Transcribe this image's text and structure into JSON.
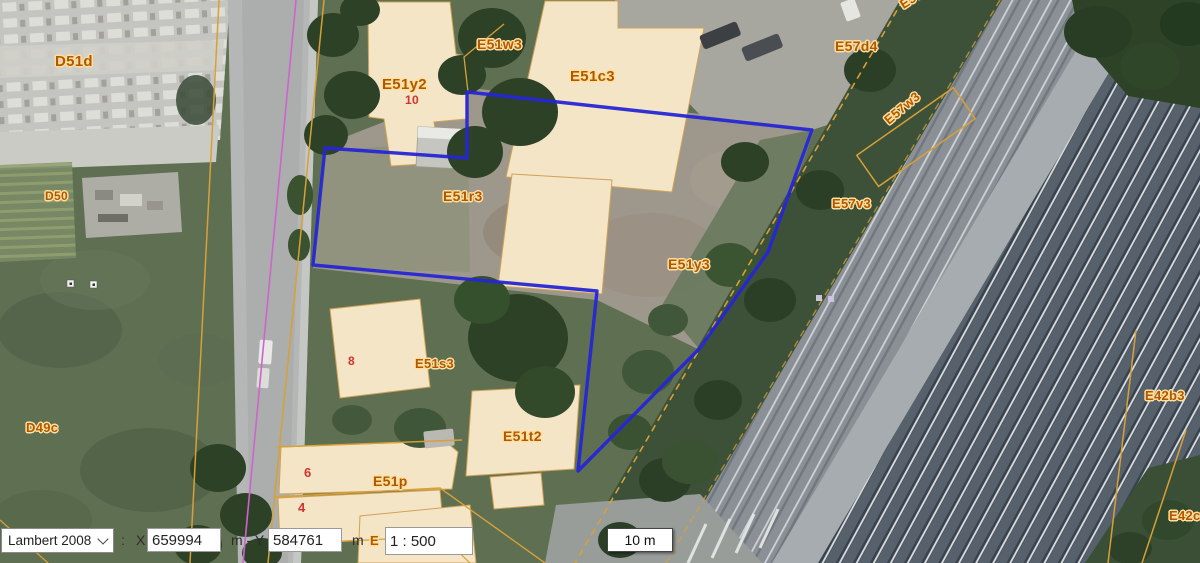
{
  "toolbar": {
    "crs_selected": "Lambert 2008",
    "colon": ":",
    "x_label": "X",
    "x_value": "659994",
    "xy_separator": "m - Y",
    "y_value": "584761",
    "y_unit": "m",
    "scale_value": "1 : 500"
  },
  "scalebar": {
    "label": "10 m"
  },
  "map": {
    "labels": [
      {
        "text": "D51d",
        "x": 55,
        "y": 53,
        "size": 15,
        "kind": "parcel"
      },
      {
        "text": "D50",
        "x": 45,
        "y": 189,
        "size": 12,
        "kind": "parcel"
      },
      {
        "text": "D49c",
        "x": 26,
        "y": 420,
        "size": 13,
        "kind": "parcel"
      },
      {
        "text": "E51y2",
        "x": 382,
        "y": 76,
        "size": 15,
        "kind": "parcel"
      },
      {
        "text": "E51w3",
        "x": 477,
        "y": 36,
        "size": 14,
        "kind": "parcel"
      },
      {
        "text": "E51c3",
        "x": 570,
        "y": 68,
        "size": 15,
        "kind": "parcel"
      },
      {
        "text": "E51r3",
        "x": 443,
        "y": 188,
        "size": 14,
        "kind": "parcel"
      },
      {
        "text": "E51y3",
        "x": 668,
        "y": 256,
        "size": 14,
        "kind": "parcel"
      },
      {
        "text": "E51s3",
        "x": 415,
        "y": 356,
        "size": 13,
        "kind": "parcel"
      },
      {
        "text": "E51t2",
        "x": 503,
        "y": 428,
        "size": 14,
        "kind": "parcel"
      },
      {
        "text": "E51p",
        "x": 373,
        "y": 473,
        "size": 14,
        "kind": "parcel"
      },
      {
        "text": "E57d4",
        "x": 835,
        "y": 38,
        "size": 14,
        "kind": "parcel"
      },
      {
        "text": "E57g4",
        "x": 901,
        "y": -2,
        "size": 13,
        "rot": -33,
        "kind": "parcel"
      },
      {
        "text": "E57w3",
        "x": 886,
        "y": 114,
        "size": 13,
        "rot": -40,
        "kind": "parcel"
      },
      {
        "text": "E57v3",
        "x": 832,
        "y": 196,
        "size": 13,
        "kind": "parcel"
      },
      {
        "text": "E42b3",
        "x": 1145,
        "y": 388,
        "size": 13,
        "kind": "parcel"
      },
      {
        "text": "E42c",
        "x": 1169,
        "y": 508,
        "size": 13,
        "kind": "parcel"
      },
      {
        "text": "E",
        "x": 370,
        "y": 533,
        "size": 13,
        "kind": "parcel"
      },
      {
        "text": "10",
        "x": 405,
        "y": 93,
        "size": 12,
        "kind": "number"
      },
      {
        "text": "8",
        "x": 348,
        "y": 354,
        "size": 12,
        "kind": "number"
      },
      {
        "text": "6",
        "x": 304,
        "y": 465,
        "size": 13,
        "kind": "number"
      },
      {
        "text": "4",
        "x": 298,
        "y": 500,
        "size": 13,
        "kind": "number"
      }
    ]
  },
  "colors": {
    "selection_blue": "#2626d4",
    "parcel_line_orange": "#d8a037",
    "parcel_label_orange": "#b05800",
    "label_halo": "#ffdf9f",
    "house_number_red": "#cf3434",
    "boundary_violet": "#cf63cf"
  }
}
